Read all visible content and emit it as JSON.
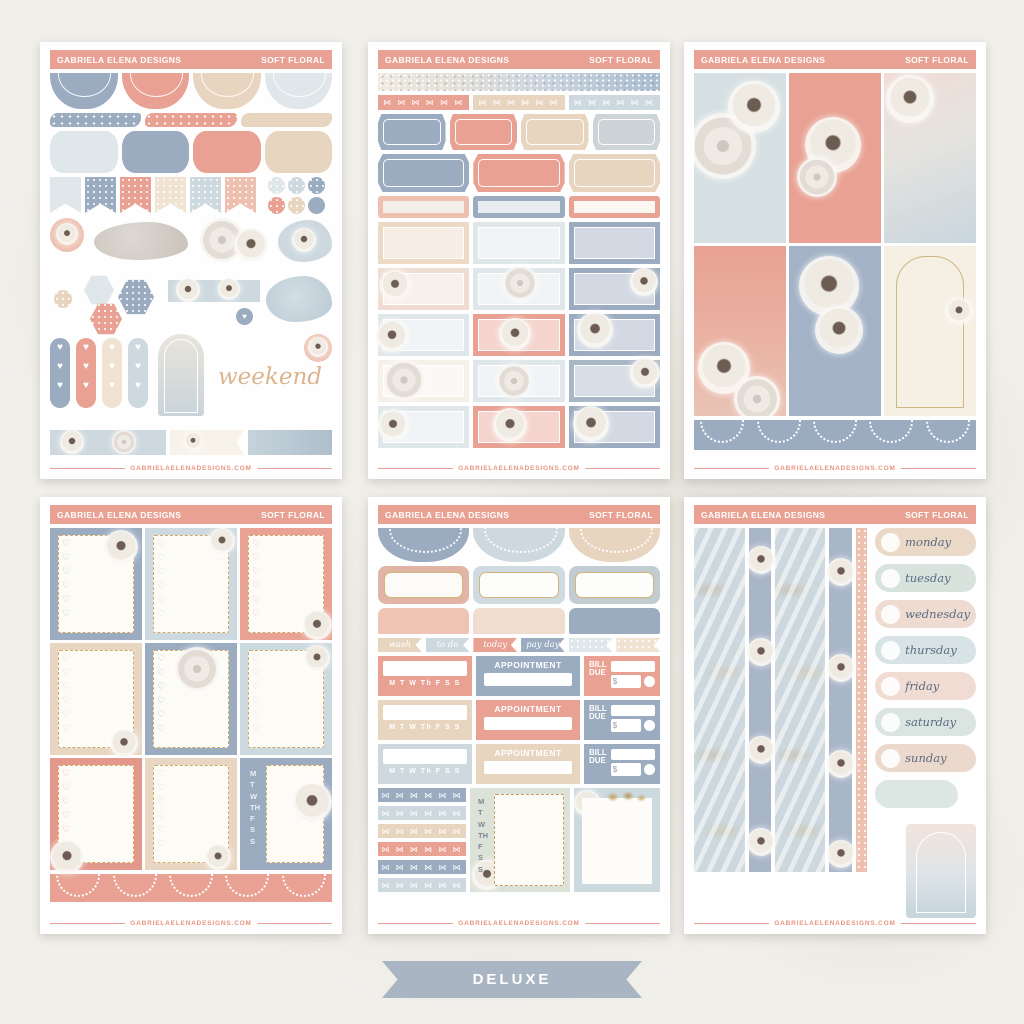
{
  "palette": {
    "salmon": "#E8A192",
    "blue_gray": "#9BABC0",
    "pale_blue": "#CDD9DF",
    "beige": "#E8D5C0",
    "cream": "#F6EFE5",
    "gold": "#CDA968",
    "footer_text": "#E89580",
    "script_tan": "#DCB48E",
    "banner_blue": "#A9B5C3",
    "day_text": "#5A6B7F",
    "sheet_bg": "#FEFEFE",
    "page_bg": "#F1EFEA"
  },
  "branding": {
    "maker": "GABRIELA ELENA DESIGNS",
    "collection": "SOFT FLORAL",
    "website": "GABRIELAELENADESIGNS.COM"
  },
  "banner": {
    "label": "DELUXE"
  },
  "icons": {
    "bow_row": "⋈ ⋈ ⋈ ⋈ ⋈ ⋈",
    "heart_banner": "♥\n♥\n♥",
    "heart": "♥",
    "heart_col": "♡\n♡\n♡\n♡\n♡\n♡",
    "week_column": "M\nT\nW\nTH\nF\nS\nS"
  },
  "sheet1": {
    "weekend_label": "weekend"
  },
  "sheet5": {
    "flags": [
      "wash",
      "to do",
      "today",
      "pay day"
    ],
    "week_row": "M T W Th F S S",
    "appointment_label": "APPOINTMENT",
    "bill_line1": "BILL",
    "bill_line2": "DUE",
    "currency": "$"
  },
  "sheet6": {
    "days": [
      "monday",
      "tuesday",
      "wednesday",
      "thursday",
      "friday",
      "saturday",
      "sunday"
    ]
  }
}
